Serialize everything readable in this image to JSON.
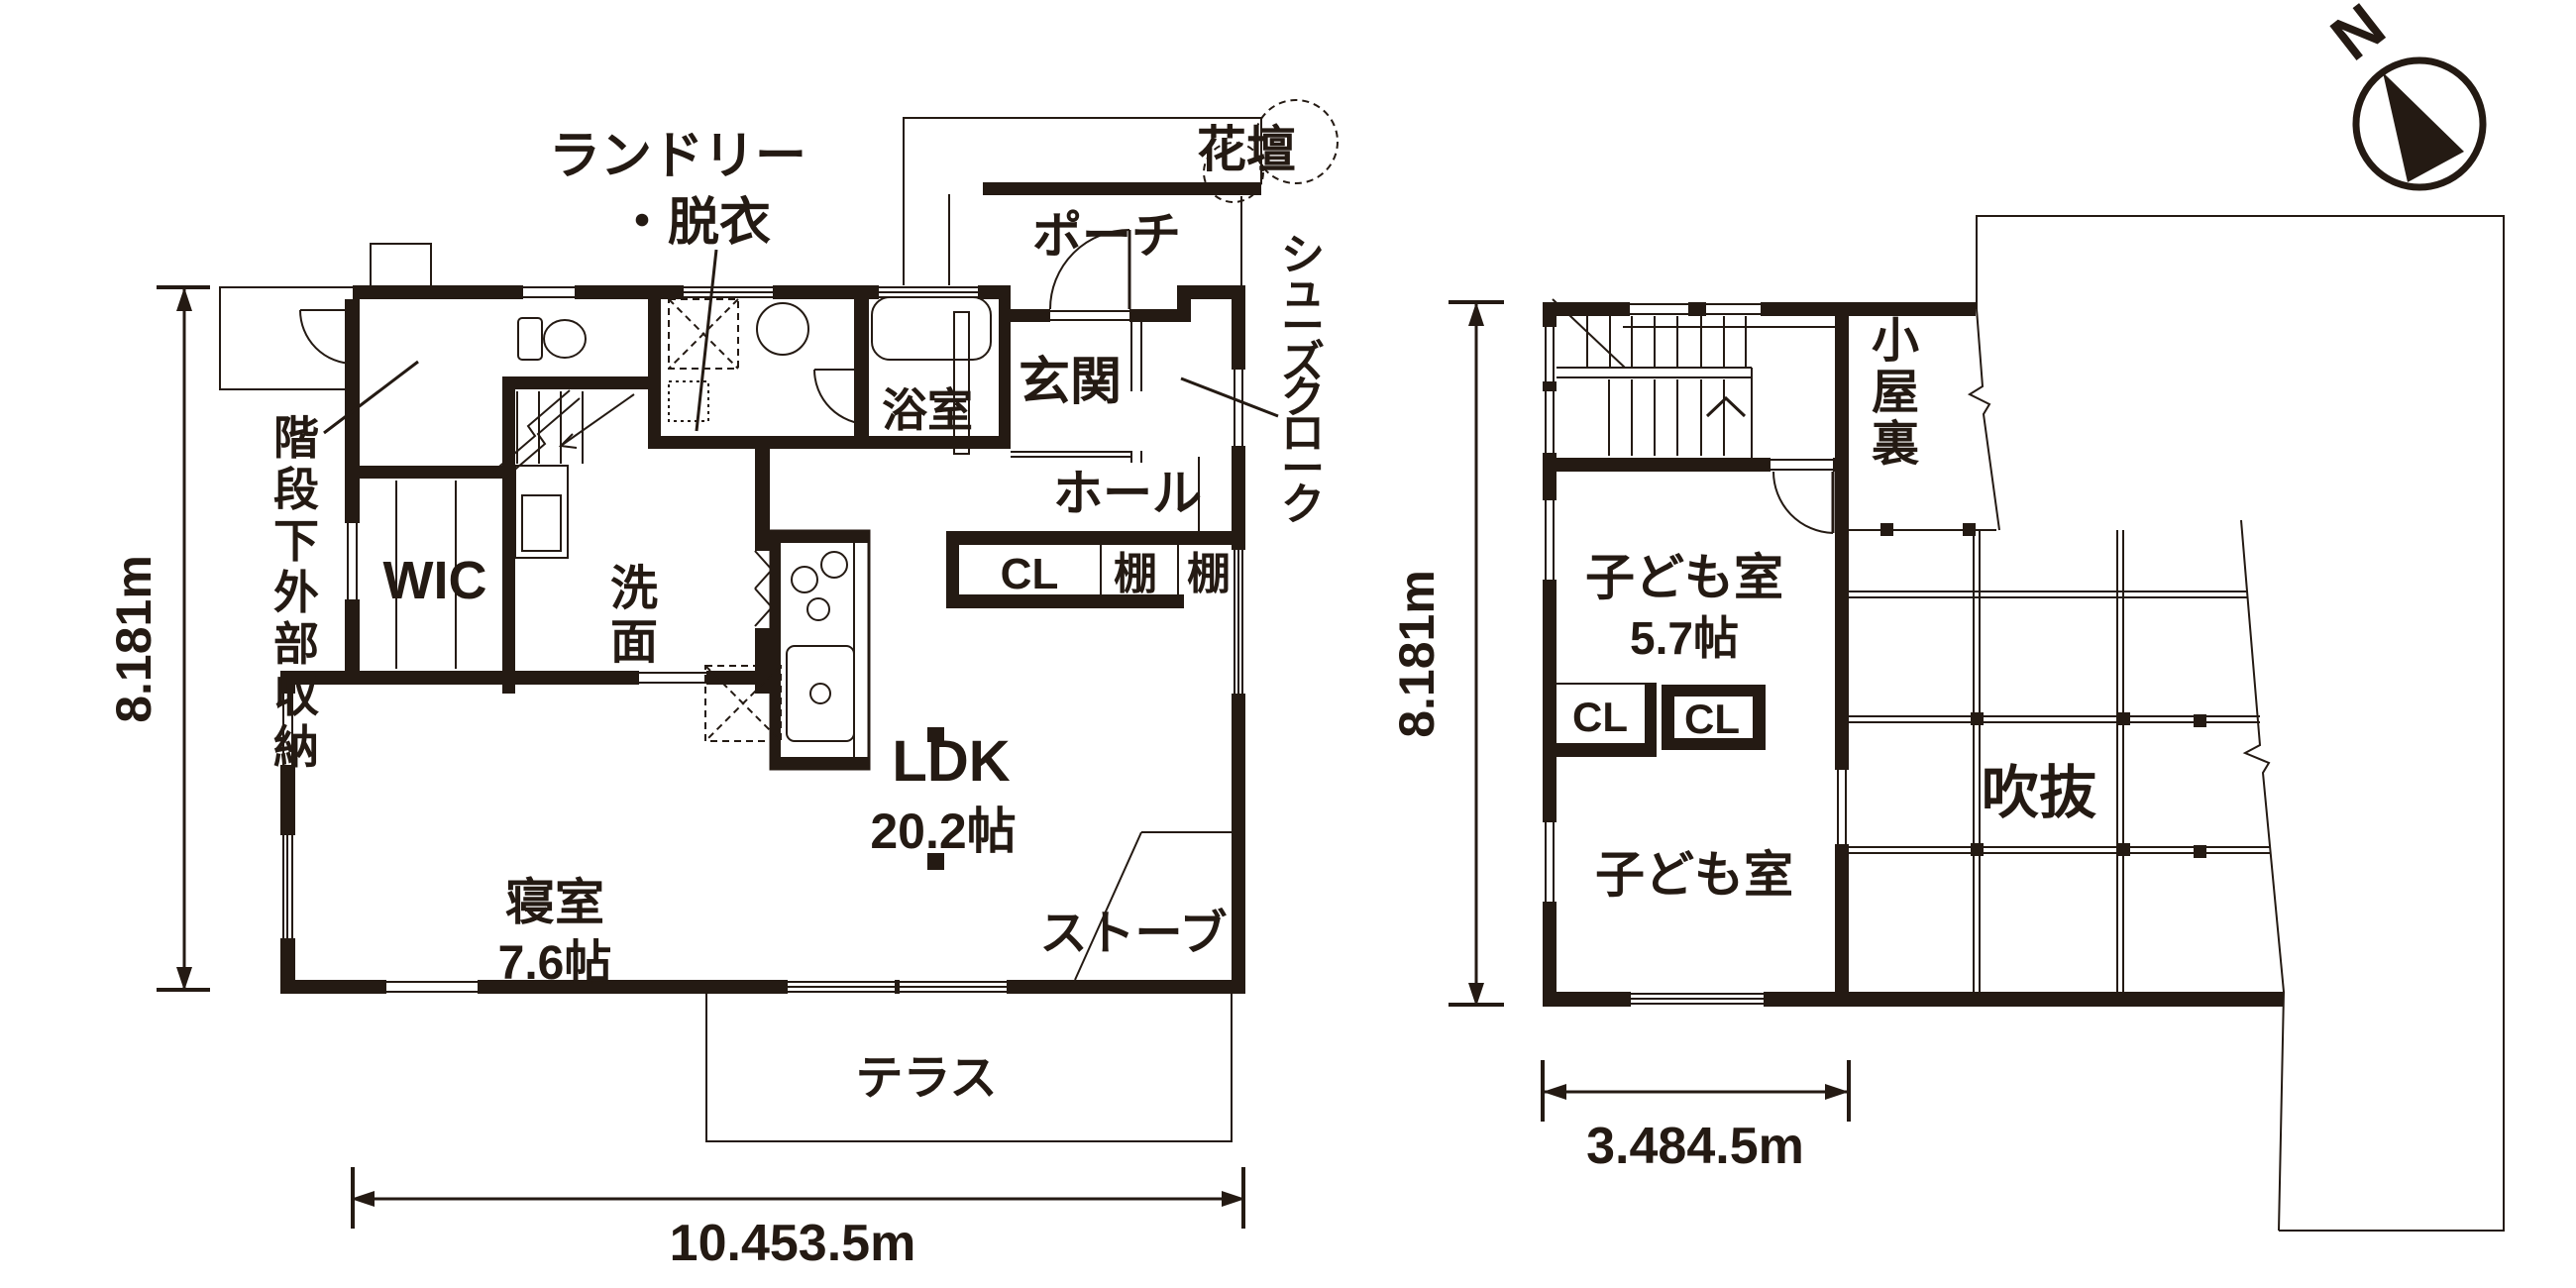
{
  "colors": {
    "ink": "#241a13",
    "background": "#ffffff"
  },
  "compass": {
    "north_label": "N"
  },
  "floor1": {
    "dim_height": "8.181m",
    "dim_width": "10.453.5m",
    "labels": {
      "laundry_line1": "ランドリー",
      "laundry_line2": "・脱衣",
      "flowerbed": "花壇",
      "porch": "ポーチ",
      "entrance": "玄関",
      "bath": "浴室",
      "hall": "ホール",
      "shoe_cloak": "シューズクローク",
      "closet": "CL",
      "shelf1": "棚",
      "shelf2": "棚",
      "under_stair_storage": "階段下外部収納",
      "wic": "WIC",
      "washroom": "洗面",
      "ldk": "LDK",
      "ldk_size": "20.2帖",
      "bedroom": "寝室",
      "bedroom_size": "7.6帖",
      "stove": "ストーブ",
      "terrace": "テラス"
    }
  },
  "floor2": {
    "dim_height": "8.181m",
    "dim_width": "3.484.5m",
    "labels": {
      "attic": "小屋裏",
      "child_room1": "子ども室",
      "child_room1_size": "5.7帖",
      "closet1": "CL",
      "closet2": "CL",
      "child_room2": "子ども室",
      "void": "吹抜"
    }
  }
}
